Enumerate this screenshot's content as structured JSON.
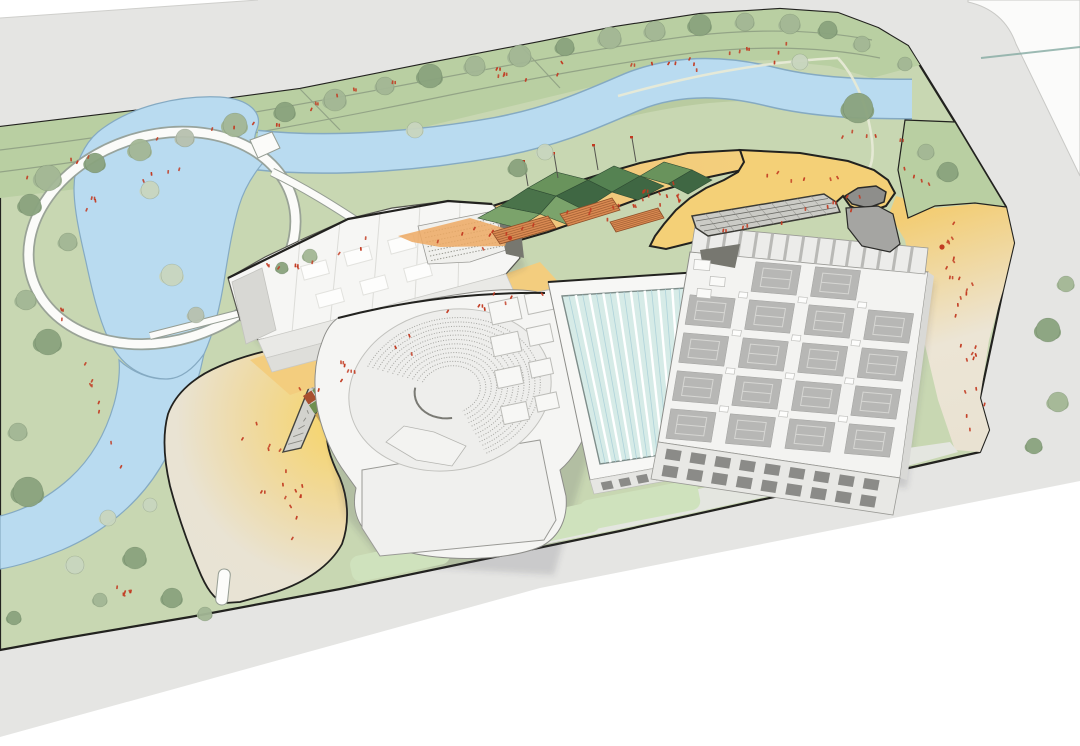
{
  "scene": {
    "kind": "architectural-site-plan-axonometric-rendering",
    "palette": {
      "bg": "#ffffff",
      "road": "#e5e5e3",
      "road_edge": "#cfcfcc",
      "parcel": "#fbfbfa",
      "parcel_line": "#c9c9c6",
      "parcel_teal_line": "#84aaa1",
      "outline": "#22221f",
      "grass": "#c8d7b2",
      "grass_dark": "#b9cfa2",
      "lawn": "#cfe2bd",
      "bank_shade": "#a9c08d",
      "water": "#b9dbf0",
      "water_edge": "#85aac2",
      "path_white": "#fbfbf9",
      "path_casing": "#959d93",
      "park_path": "#8a9a80",
      "hill_path": "#e7ead6",
      "plaza_beige": "#e9e3d4",
      "plaza_yellow": "#f6d266",
      "mid_plaza": "#f3cd7e",
      "deck_orange": "#f0c67c",
      "deck_orange_deep": "#eda963",
      "deck_yellow": "#f4d077",
      "terrace_wood": "#d98a52",
      "terrace_wood_dark": "#8f4f28",
      "canopy_a": "#4a734a",
      "canopy_b": "#69935c",
      "canopy_c": "#3f6743",
      "canopy_d": "#7ba36b",
      "canopy_e": "#558252",
      "building_face": "#f5f5f3",
      "building_wall": "#e8e8e5",
      "building_line": "#9a9a96",
      "building_dark": "#8b8b88",
      "slot_gray": "#cbcbc6",
      "funnel_gray": "#8e8e8b",
      "court": "#b7b7b5",
      "court_line": "#d6d6d3",
      "pool_water": "#d6ebe7",
      "pool_edge": "#7e8d8a",
      "pool_lane_line": "#ffffff",
      "pool_lane_thin": "#aed2da",
      "seat_line": "#a6a6a2",
      "people": "#c23a21",
      "tree_pale": "#c9d6bf",
      "tree_mid": "#a3b795",
      "tree_dark": "#8aa37e",
      "tree_gray": "#b7c1af",
      "trunk": "#7a8572",
      "shadow": "rgba(60,60,72,0.16)"
    },
    "pool": {
      "lane_count": 9
    },
    "roof_courts": {
      "rows": 5,
      "cols": 4
    },
    "auditorium": {
      "seat_row_count": 12
    },
    "grandstand": {
      "row_count": 7
    },
    "north_wing": {
      "bay_count": 15
    },
    "east_facade": {
      "bay_count": 9
    },
    "pool_facade": {
      "window_count": 6
    },
    "trees": {
      "count": 50
    },
    "people": {
      "approx_count": 175
    }
  }
}
